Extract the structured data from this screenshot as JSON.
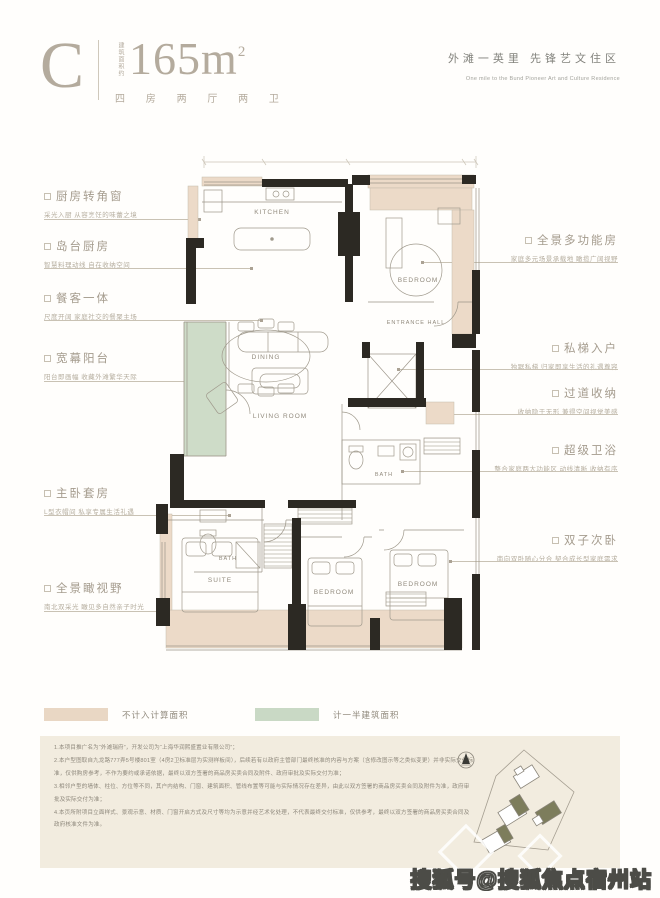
{
  "header": {
    "type_label": "C",
    "area_prefix": "建筑面积约",
    "area_value": "165m",
    "area_exp": "2",
    "layout_label": "四 房 两 厅 两 卫",
    "slogan_cn": "外滩一英里  先锋艺文住区",
    "slogan_en": "One mile to the Bund Pioneer Art and Culture Residence"
  },
  "annotations": {
    "left": [
      {
        "title": "厨房转角窗",
        "desc": "采光入厨 从容烹饪的味蕾之境"
      },
      {
        "title": "岛台厨房",
        "desc": "智慧料理动线 自在收纳空间"
      },
      {
        "title": "餐客一体",
        "desc": "尺度开阔 家庭社交的餐聚主场"
      },
      {
        "title": "宽幕阳台",
        "desc": "阳台即画幅 收藏外滩繁华天际"
      },
      {
        "title": "主卧套房",
        "desc": "L型衣帽间 私享专属生活礼遇"
      },
      {
        "title": "全景瞰视野",
        "desc": "南北双采光 瞰见多自然亲子时光"
      }
    ],
    "right": [
      {
        "title": "全景多功能房",
        "desc": "家庭多元场景承载地 瞰揽广阔视野"
      },
      {
        "title": "私梯入户",
        "desc": "独踞私梯 归家即享生活的礼遇尊容"
      },
      {
        "title": "过道收纳",
        "desc": "收纳隐于无形 兼得空间视觉美感"
      },
      {
        "title": "超级卫浴",
        "desc": "整合家庭两大功能区 动线清晰 收纳有序"
      },
      {
        "title": "双子次卧",
        "desc": "南向双卧随心分合 契合成长型家庭需求"
      }
    ]
  },
  "plan": {
    "rooms": {
      "kitchen": "KITCHEN",
      "dining": "DINING",
      "bedroom_top": "BEDROOM",
      "entrance": "ENTRANCE HALL",
      "living": "LIVING ROOM",
      "bath_a": "BATH",
      "bath_b": "BATH",
      "suite": "SUITE",
      "bedroom_mid": "BEDROOM",
      "bedroom_right": "BEDROOM"
    }
  },
  "legend": {
    "items": [
      {
        "label": "不计入计算面积",
        "color": "#e9d7c4"
      },
      {
        "label": "计一半建筑面积",
        "color": "#c9d9c5"
      }
    ]
  },
  "disclaimer": {
    "lines": [
      "1.本项目推广名为“外滩瑞府”，开发公司为“上海华润熙盛置业有限公司”；",
      "2.本户型图取自九龙路777弄5号楼801室（4房2卫标准层为实测样板间），后续若有以政府主管部门最终核准的内容与方案（含修改图示等之类似变更）并非实际交付标准，仅供购房参考，不作为要约或承诺依据，最终以双方签署的商品房买卖合同及附件、政府审批及实际交付为准；",
      "3.相邻户型的墙体、柱位、方位等不同，其户内结构、门窗、建筑面积、管线布置等可能与实际情况存在差异，由此以双方签署的商品房买卖合同及附件为准，政府审批及实际交付为准；",
      "4.本页所附项目立面样式、景观示意、材质、门窗开启方式及尺寸等均为示意并经艺术化处理，不代表最终交付标准，仅供参考，最终以双方签署的商品房买卖合同及政府核准文件为准。"
    ]
  },
  "watermark": "搜狐号@搜狐焦点宿州站",
  "colors": {
    "not_counted_area": "#e9d7c4",
    "half_counted_area": "#c9d9c5",
    "wall": "#2c2923",
    "title": "#b4ab9d",
    "panel_bg": "#f2ecdf",
    "site_highlight": "#7d7d5c"
  }
}
